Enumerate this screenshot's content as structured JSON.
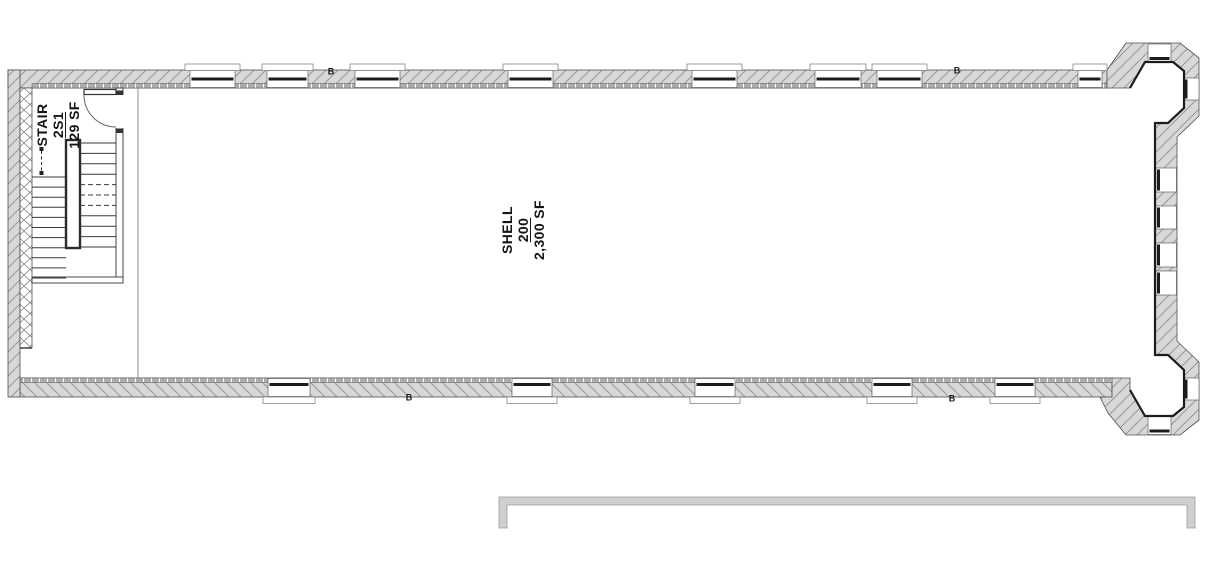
{
  "drawing_type": "architectural floor plan",
  "rooms": {
    "stair": {
      "name": "STAIR",
      "number": "2S1",
      "area": "129 SF"
    },
    "shell": {
      "name": "SHELL",
      "number": "200",
      "area": "2,300 SF"
    }
  },
  "keynotes": [
    {
      "label": "B"
    },
    {
      "label": "B"
    },
    {
      "label": "B"
    },
    {
      "label": "B"
    }
  ],
  "colors": {
    "wall_fill": "#d8d8d8",
    "hatch_line": "#909090",
    "outline": "#4f4f4f",
    "heavy_line": "#1c1c1c",
    "tick_band": "#aeaeae",
    "lower_outline_fill": "#cfcfcf",
    "lower_outline_edge": "#9a9a9a"
  }
}
